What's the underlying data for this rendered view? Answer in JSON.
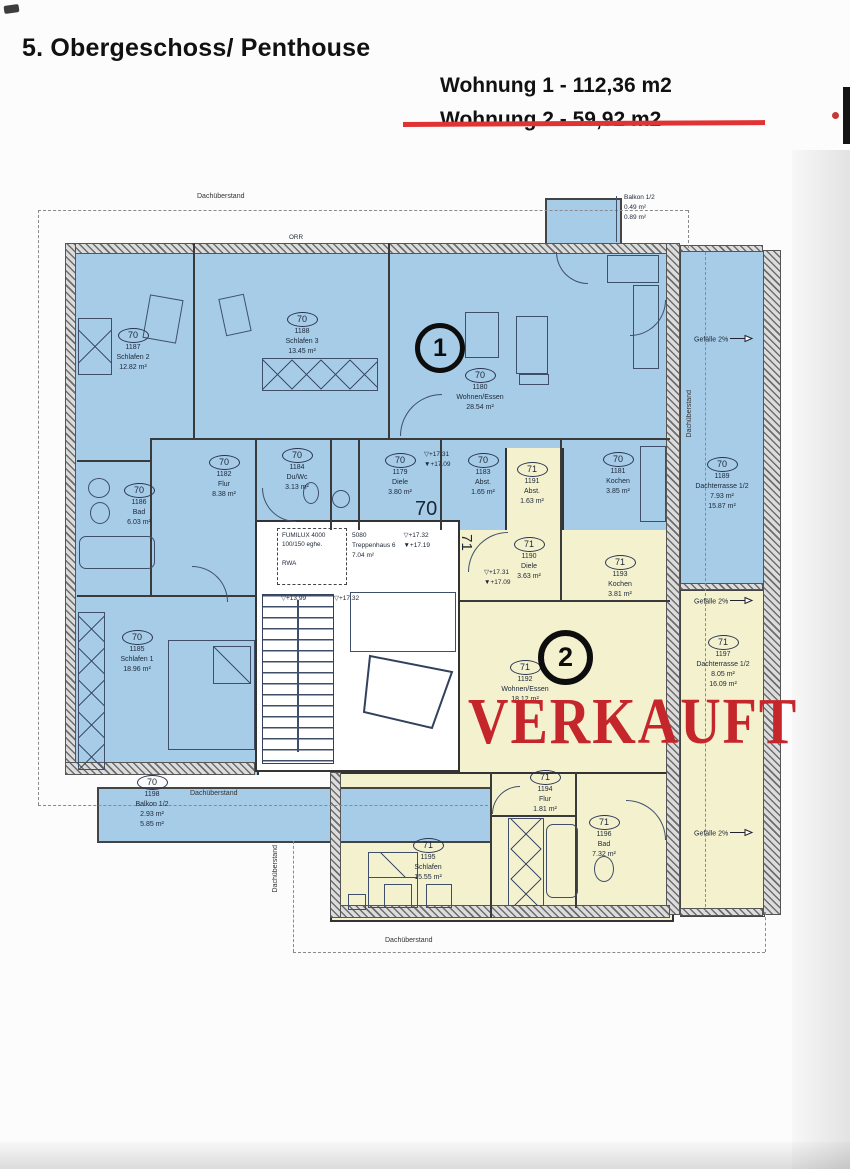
{
  "header": {
    "title": "5. Obergeschoss/ Penthouse",
    "apartment1": "Wohnung 1 - 112,36 m2",
    "apartment2": "Wohnung 2 - 59,92 m2"
  },
  "stamp": {
    "sold": "VERKAUFT"
  },
  "markers": {
    "apartment1": "1",
    "apartment2": "2",
    "zone70": "70",
    "zone71": "71"
  },
  "colors": {
    "apartment1_fill": "#a6cce8",
    "apartment2_fill": "#f4f1cf",
    "stamp_red": "#c5262b",
    "strike_red": "#e03434",
    "wall": "#3a3a3a"
  },
  "plan": {
    "rooms": [
      {
        "unit": "70",
        "id": "1187",
        "name": "Schlafen 2",
        "areas": [
          "12.82 m²"
        ],
        "cx": 133,
        "y": 328
      },
      {
        "unit": "70",
        "id": "1188",
        "name": "Schlafen 3",
        "areas": [
          "13.45 m²"
        ],
        "cx": 302,
        "y": 312
      },
      {
        "unit": "70",
        "id": "1180",
        "name": "Wohnen/Essen",
        "areas": [
          "28.54 m²"
        ],
        "cx": 480,
        "y": 368
      },
      {
        "unit": "70",
        "id": "1182",
        "name": "Flur",
        "areas": [
          "8.38 m²"
        ],
        "cx": 224,
        "y": 455
      },
      {
        "unit": "70",
        "id": "1184",
        "name": "Du/Wc",
        "areas": [
          "3.13 m²"
        ],
        "cx": 297,
        "y": 448
      },
      {
        "unit": "70",
        "id": "1179",
        "name": "Diele",
        "areas": [
          "3.80 m²"
        ],
        "cx": 400,
        "y": 453
      },
      {
        "unit": "70",
        "id": "1183",
        "name": "Abst.",
        "areas": [
          "1.65 m²"
        ],
        "cx": 483,
        "y": 453
      },
      {
        "unit": "71",
        "id": "1191",
        "name": "Abst.",
        "areas": [
          "1.63 m²"
        ],
        "cx": 532,
        "y": 462
      },
      {
        "unit": "70",
        "id": "1181",
        "name": "Kochen",
        "areas": [
          "3.85 m²"
        ],
        "cx": 618,
        "y": 452
      },
      {
        "unit": "70",
        "id": "1186",
        "name": "Bad",
        "areas": [
          "6.03 m²"
        ],
        "cx": 139,
        "y": 483
      },
      {
        "unit": "70",
        "id": "1185",
        "name": "Schlafen 1",
        "areas": [
          "18.96 m²"
        ],
        "cx": 137,
        "y": 630
      },
      {
        "unit": "70",
        "id": "1189",
        "name": "Dachterrasse 1/2",
        "areas": [
          "7.93 m²",
          "15.87 m²"
        ],
        "cx": 722,
        "y": 457
      },
      {
        "unit": "70",
        "id": "1198",
        "name": "Balkon 1/2",
        "areas": [
          "2.93 m²",
          "5.85 m²"
        ],
        "cx": 152,
        "y": 775
      },
      {
        "unit": "71",
        "id": "1190",
        "name": "Diele",
        "areas": [
          "3.63 m²"
        ],
        "cx": 529,
        "y": 537
      },
      {
        "unit": "71",
        "id": "1193",
        "name": "Kochen",
        "areas": [
          "3.81 m²"
        ],
        "cx": 620,
        "y": 555
      },
      {
        "unit": "71",
        "id": "1192",
        "name": "Wohnen/Essen",
        "areas": [
          "18.12 m²"
        ],
        "cx": 525,
        "y": 660
      },
      {
        "unit": "71",
        "id": "1197",
        "name": "Dachterrasse 1/2",
        "areas": [
          "8.05 m²",
          "16.09 m²"
        ],
        "cx": 723,
        "y": 635
      },
      {
        "unit": "71",
        "id": "1194",
        "name": "Flur",
        "areas": [
          "1.81 m²"
        ],
        "cx": 545,
        "y": 770
      },
      {
        "unit": "71",
        "id": "1196",
        "name": "Bad",
        "areas": [
          "7.32 m²"
        ],
        "cx": 604,
        "y": 815
      },
      {
        "unit": "71",
        "id": "1195",
        "name": "Schlafen",
        "areas": [
          "15.55 m²"
        ],
        "cx": 428,
        "y": 838
      }
    ],
    "stairwell": {
      "vent_lines": [
        "FUMILUX 4000",
        "100/150 eghe.",
        "RWA"
      ],
      "id": "5080",
      "name": "Treppenhaus 6",
      "area": "7.04 m²",
      "level_top": "▽+17.32",
      "level_bottom": "▼+17.19"
    },
    "elevations": [
      {
        "lines": [
          "▽+17.31",
          "▼+17.09"
        ],
        "x": 424,
        "y": 450
      },
      {
        "lines": [
          "▽+17.31",
          "▼+17.09"
        ],
        "x": 484,
        "y": 568
      },
      {
        "lines": [
          "▽+13,99"
        ],
        "x": 281,
        "y": 594
      },
      {
        "lines": [
          "▽+17.32"
        ],
        "x": 334,
        "y": 594
      }
    ],
    "slopes": [
      {
        "label": "Gefälle 2%",
        "x": 694,
        "y": 334
      },
      {
        "label": "Gefälle 2%",
        "x": 694,
        "y": 596
      },
      {
        "label": "Gefälle 2%",
        "x": 694,
        "y": 828
      }
    ],
    "overhangs": [
      {
        "label": "Dachüberstand",
        "x": 197,
        "y": 193,
        "vertical": false
      },
      {
        "label": "Dachüberstand",
        "x": 686,
        "y": 390,
        "vertical": true
      },
      {
        "label": "Dachüberstand",
        "x": 190,
        "y": 790,
        "vertical": false
      },
      {
        "label": "Dachüberstand",
        "x": 272,
        "y": 845,
        "vertical": true
      },
      {
        "label": "Dachüberstand",
        "x": 385,
        "y": 937,
        "vertical": false
      }
    ],
    "top_balcony": {
      "lines": [
        "Balkon 1/2",
        "0.49 m²",
        "0.89 m²"
      ]
    },
    "wall_note": "ORR"
  }
}
